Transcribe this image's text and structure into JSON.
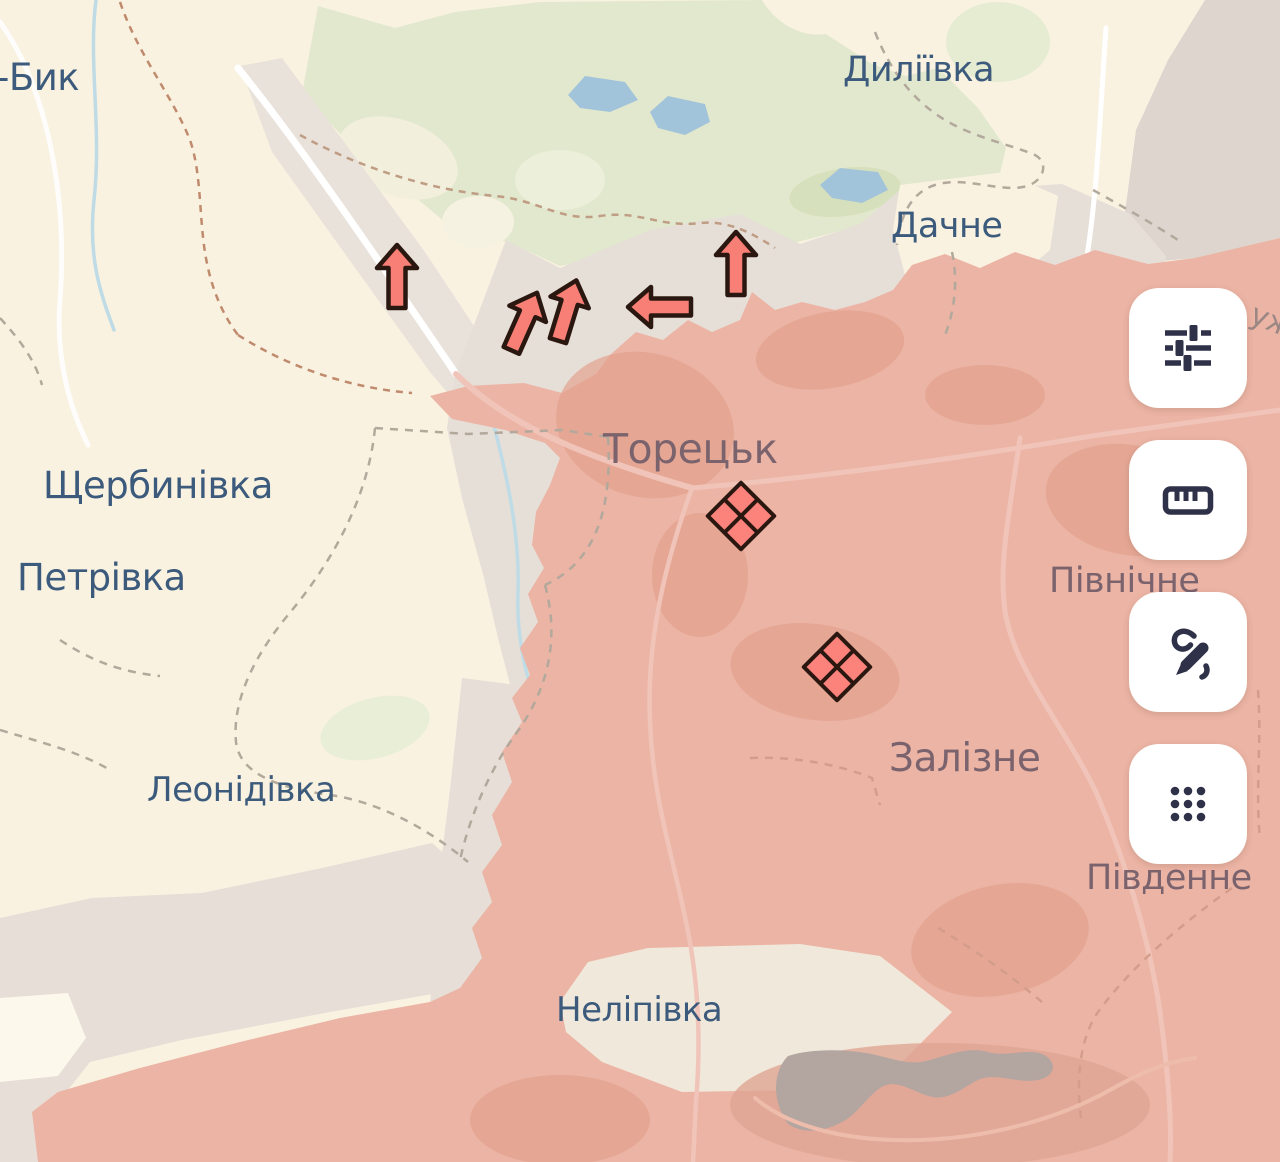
{
  "map": {
    "labels": [
      {
        "id": "byk",
        "text": "-Бик",
        "x": -4,
        "y": 90,
        "size": 37,
        "style": "free"
      },
      {
        "id": "dyliivka",
        "text": "Диліївка",
        "x": 843,
        "y": 81,
        "size": 35,
        "style": "free"
      },
      {
        "id": "dachne",
        "text": "Дачне",
        "x": 891,
        "y": 237,
        "size": 35,
        "style": "free"
      },
      {
        "id": "shcherbynivka",
        "text": "Щербинівка",
        "x": 43,
        "y": 498,
        "size": 37,
        "style": "free"
      },
      {
        "id": "petrivka",
        "text": "Петрівка",
        "x": 17,
        "y": 590,
        "size": 37,
        "style": "free"
      },
      {
        "id": "leonidivka",
        "text": "Леонідівка",
        "x": 147,
        "y": 801,
        "size": 34,
        "style": "free"
      },
      {
        "id": "nelipivka",
        "text": "Неліпівка",
        "x": 556,
        "y": 1021,
        "size": 34,
        "style": "free"
      },
      {
        "id": "toretsk",
        "text": "Торецьк",
        "x": 603,
        "y": 463,
        "size": 41,
        "style": "occupied"
      },
      {
        "id": "pivnichne",
        "text": "Північне",
        "x": 1049,
        "y": 592,
        "size": 35,
        "style": "occupied"
      },
      {
        "id": "zalizne",
        "text": "Залізне",
        "x": 889,
        "y": 771,
        "size": 39,
        "style": "occupied"
      },
      {
        "id": "pivdenne",
        "text": "Південне",
        "x": 1086,
        "y": 889,
        "size": 35,
        "style": "occupied"
      },
      {
        "id": "partial-edge",
        "text": "уж",
        "x": 1248,
        "y": 322,
        "size": 30,
        "style": "occupied-light",
        "rotate": 22
      }
    ],
    "markers": {
      "attack_arrows": [
        {
          "x": 397,
          "y": 277,
          "rotate": 0
        },
        {
          "x": 524,
          "y": 322,
          "rotate": 24
        },
        {
          "x": 567,
          "y": 311,
          "rotate": 17
        },
        {
          "x": 660,
          "y": 307,
          "rotate": -90
        },
        {
          "x": 736,
          "y": 264,
          "rotate": 0
        }
      ],
      "clash_diamonds": [
        {
          "x": 741,
          "y": 516
        },
        {
          "x": 837,
          "y": 667
        }
      ]
    },
    "legend_colors": {
      "free_territory": "#f9f2e1",
      "forest": "#e2e8cd",
      "water": "#a2c4da",
      "contested_zone": "#e6dfd8",
      "occupied_zone": "#ecb4a4",
      "marker_fill": "#f87f76",
      "marker_outline": "#2a1810",
      "label_free": "#3c5a7b",
      "label_occupied": "#755f6b"
    }
  },
  "toolbar": {
    "buttons": [
      {
        "id": "map-filters-button",
        "icon": "sliders-icon"
      },
      {
        "id": "measure-button",
        "icon": "ruler-icon"
      },
      {
        "id": "draw-button",
        "icon": "pen-scribble-icon"
      },
      {
        "id": "apps-grid-button",
        "icon": "grid-dots-icon"
      }
    ],
    "button_bg": "#ffffff",
    "button_icon_color": "#2e3148"
  }
}
